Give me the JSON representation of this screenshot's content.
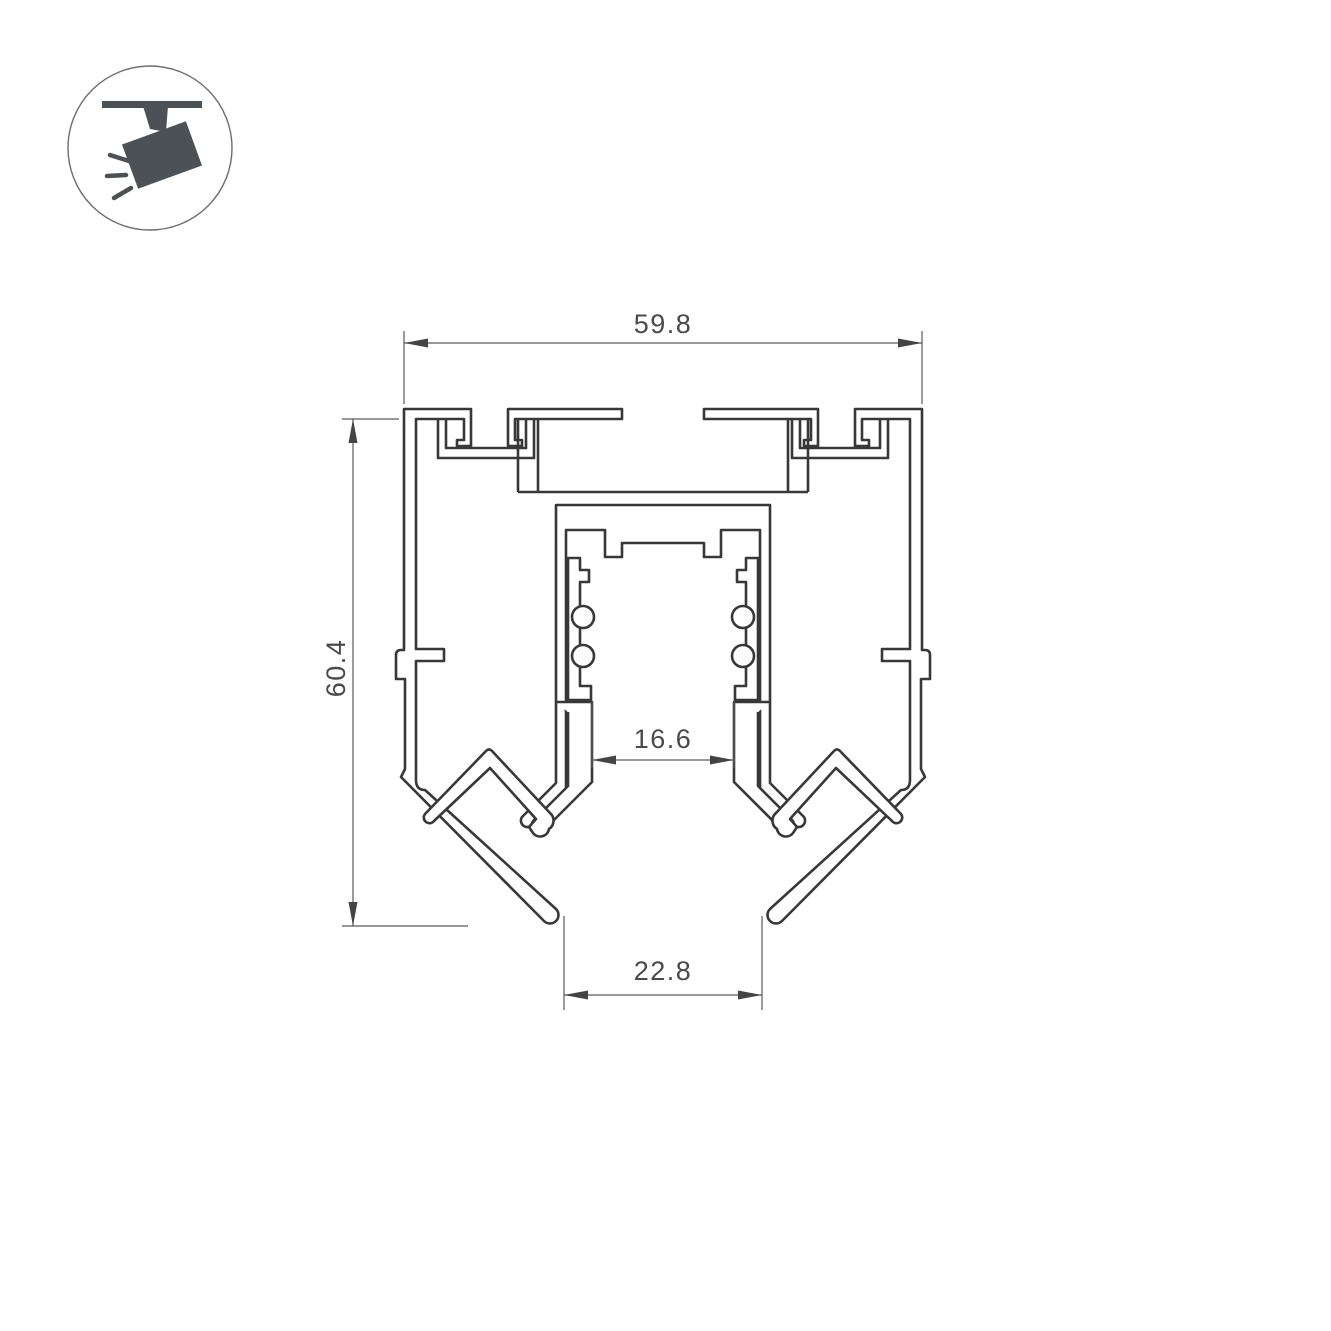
{
  "drawing": {
    "type": "profile-cross-section",
    "subject": "recessed magnetic track profile",
    "dimensions": {
      "overall_width": "59.8",
      "overall_height": "60.4",
      "track_opening_width": "16.6",
      "bottom_opening_width": "22.8"
    },
    "icon": {
      "symbol": "ceiling-track-spotlight-icon"
    },
    "colors": {
      "background": "#ffffff",
      "profile_line": "#383838",
      "dimension_line": "#5a5a5a",
      "dimension_text": "#4a4a4a",
      "icon_fill": "#4c5156"
    }
  }
}
